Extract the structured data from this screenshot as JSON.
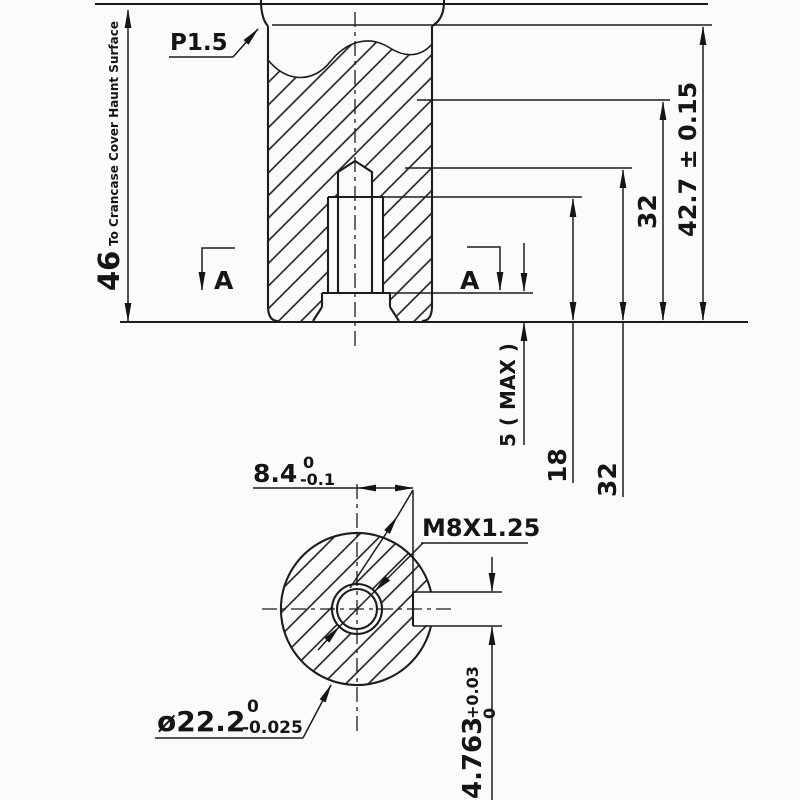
{
  "section": {
    "fillet_label": "P1.5",
    "height_dim": {
      "value": "46",
      "note": "To Crancase Cover Haunt Surface"
    },
    "marker_left": "A",
    "marker_right": "A",
    "overall_dim": "42.7 ± 0.15",
    "dim_32_inline": "32",
    "dim_32_below": "32",
    "dim_18": "18",
    "dim_5_max": "5 ( MAX )"
  },
  "bottom": {
    "offset_dim": {
      "value": "8.4",
      "tol_top": "0",
      "tol_bottom": "-0.1"
    },
    "thread_label": "M8X1.25",
    "diameter_dim": {
      "value": "ø22.2",
      "tol_top": "0",
      "tol_bottom": "-0.025"
    },
    "slot_dim": {
      "value": "4.763",
      "tol_top": "+0.03",
      "tol_bottom": "0"
    }
  }
}
